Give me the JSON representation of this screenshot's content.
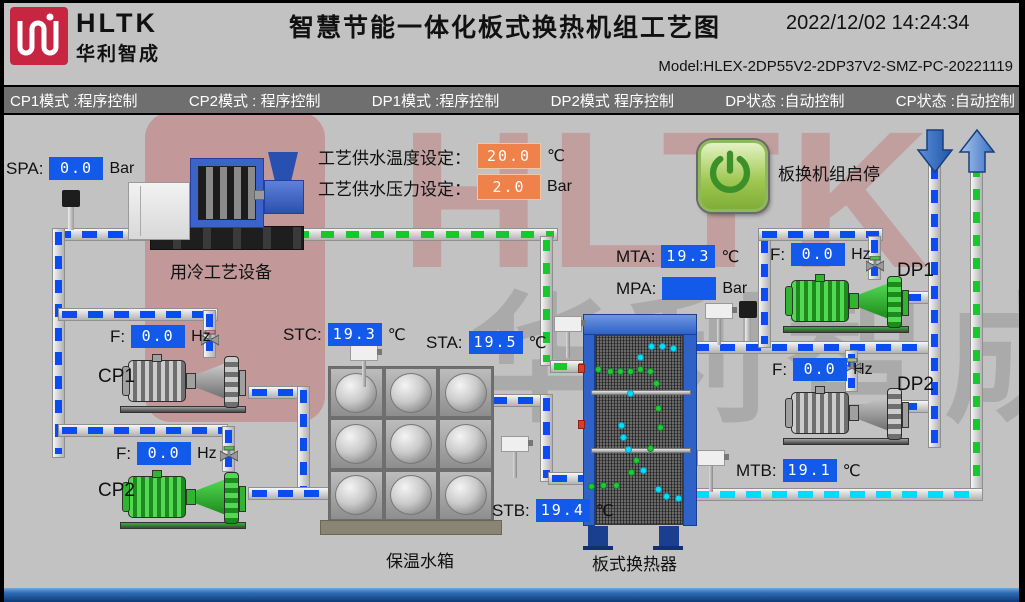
{
  "header": {
    "logo_brand": "HLTK",
    "logo_sub": "华利智成",
    "title": "智慧节能一体化板式换热机组工艺图",
    "datetime": "2022/12/02 14:24:34",
    "model": "Model:HLEX-2DP55V2-2DP37V2-SMZ-PC-20221119"
  },
  "status_bar": {
    "items": [
      "CP1模式 :程序控制",
      "CP2模式 : 程序控制",
      "DP1模式 :程序控制",
      "DP2模式 程序控制",
      "DP状态 :自动控制",
      "CP状态 :自动控制"
    ]
  },
  "watermark": {
    "text_latin": "HLTK",
    "text_cn": "华利智成"
  },
  "setpoints": {
    "temp": {
      "label": "工艺供水温度设定：",
      "value": "20.0",
      "unit": "℃"
    },
    "pressure": {
      "label": "工艺供水压力设定：",
      "value": "2.0",
      "unit": "Bar"
    }
  },
  "readouts": {
    "spa": {
      "label": "SPA:",
      "value": "0.0",
      "unit": "Bar"
    },
    "stc": {
      "label": "STC:",
      "value": "19.3",
      "unit": "℃"
    },
    "sta": {
      "label": "STA:",
      "value": "19.5",
      "unit": "℃"
    },
    "stb": {
      "label": "STB:",
      "value": "19.4",
      "unit": "℃"
    },
    "mta": {
      "label": "MTA:",
      "value": "19.3",
      "unit": "℃"
    },
    "mpa": {
      "label": "MPA:",
      "value": "",
      "unit": "Bar"
    },
    "mtb": {
      "label": "MTB:",
      "value": "19.1",
      "unit": "℃"
    },
    "cp1_freq": {
      "label": "F:",
      "value": "0.0",
      "unit": "Hz"
    },
    "cp2_freq": {
      "label": "F:",
      "value": "0.0",
      "unit": "Hz"
    },
    "dp1_freq": {
      "label": "F:",
      "value": "0.0",
      "unit": "Hz"
    },
    "dp2_freq": {
      "label": "F:",
      "value": "0.0",
      "unit": "Hz"
    }
  },
  "equipment": {
    "cooling_device_label": "用冷工艺设备",
    "tank_label": "保温水箱",
    "hx_label": "板式换热器",
    "cp1_label": "CP1",
    "cp2_label": "CP2",
    "dp1_label": "DP1",
    "dp2_label": "DP2",
    "power_button_label": "板换机组启停"
  },
  "colors": {
    "value_box_blue": "#1359ea",
    "setpoint_box_orange": "#ef814b",
    "pump_running_green": "#2fb52f",
    "pump_stopped_gray": "#a0a0a0",
    "dash_blue": "#0a4cf0",
    "dash_green": "#17c72e",
    "dash_cyan": "#00dcff",
    "logo_red": "#c62641"
  }
}
